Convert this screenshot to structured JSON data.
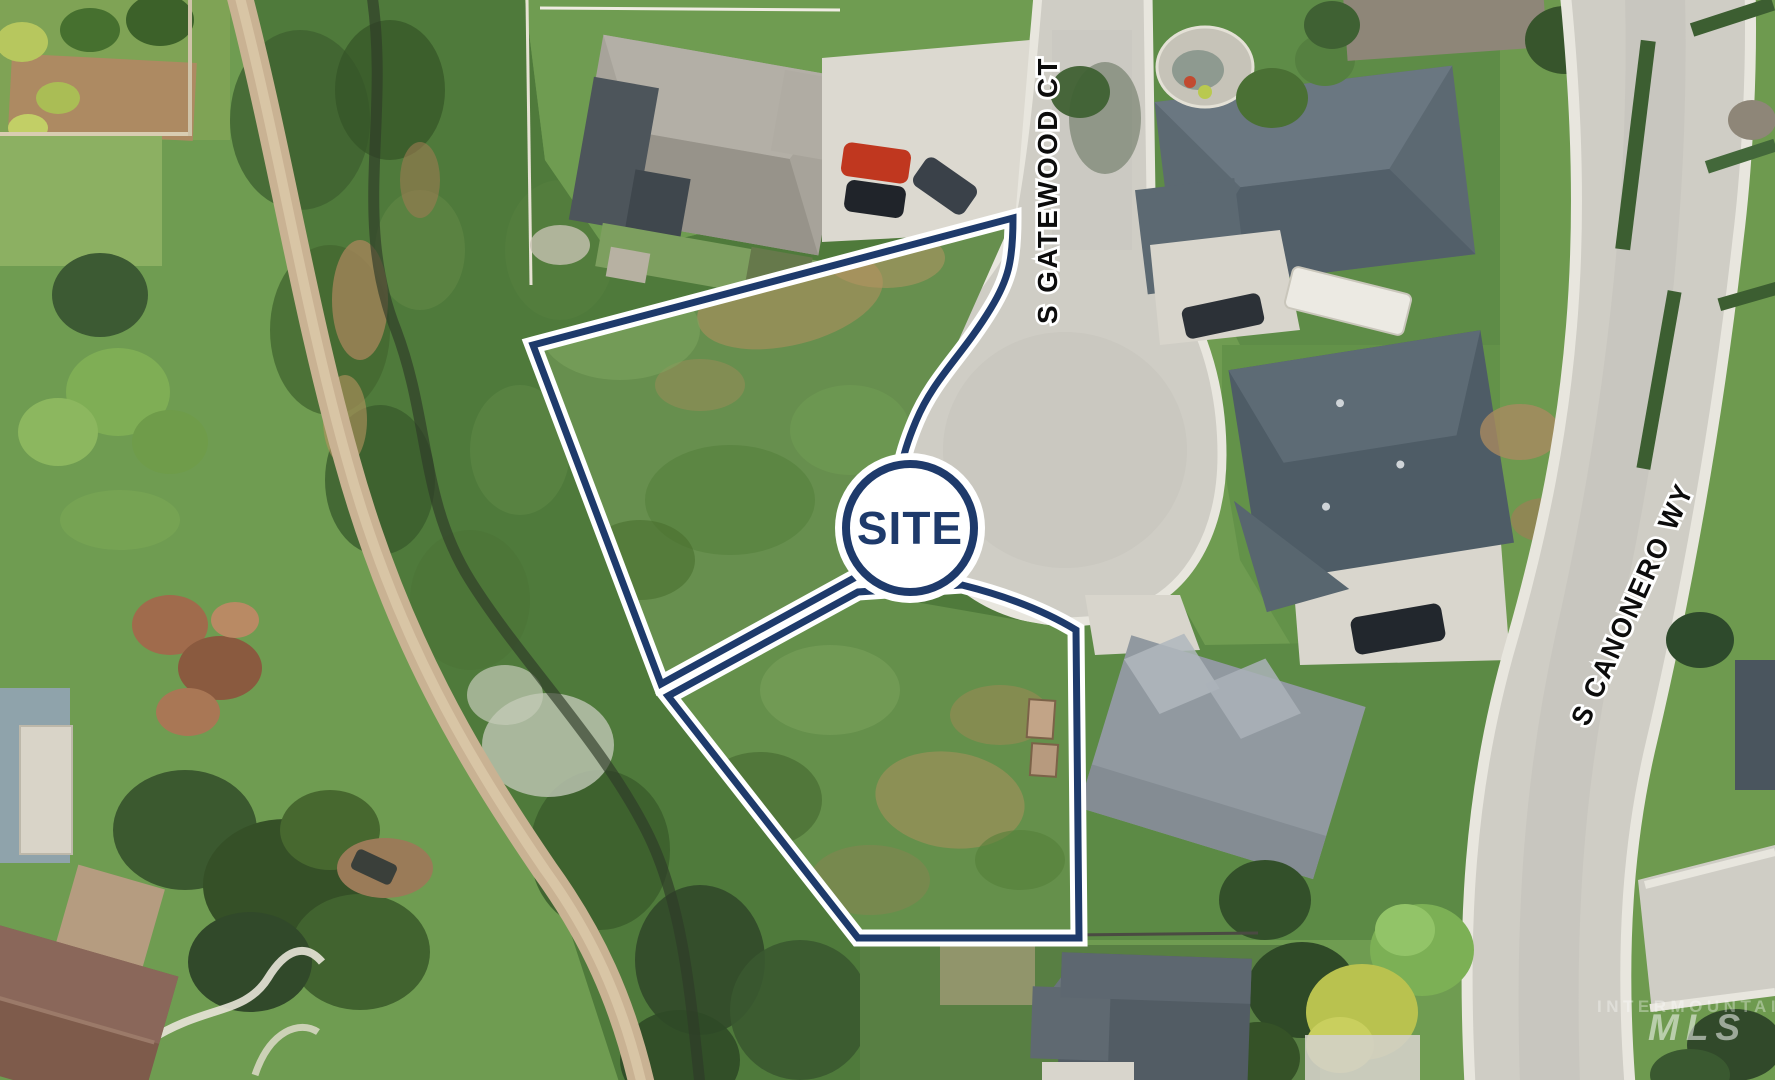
{
  "map": {
    "site_marker": {
      "label": "SITE"
    },
    "streets": {
      "gatewood": "S GATEWOOD CT",
      "canonero": "S CANONERO WY"
    },
    "watermark": {
      "line1": "INTERMOUNTAIN",
      "line2": "MLS"
    },
    "colors": {
      "boundary": "#1e3a6b",
      "boundary_casing": "#ffffff",
      "site_text": "#1e3a6b",
      "street_label_fill": "#0c0c0c"
    }
  }
}
